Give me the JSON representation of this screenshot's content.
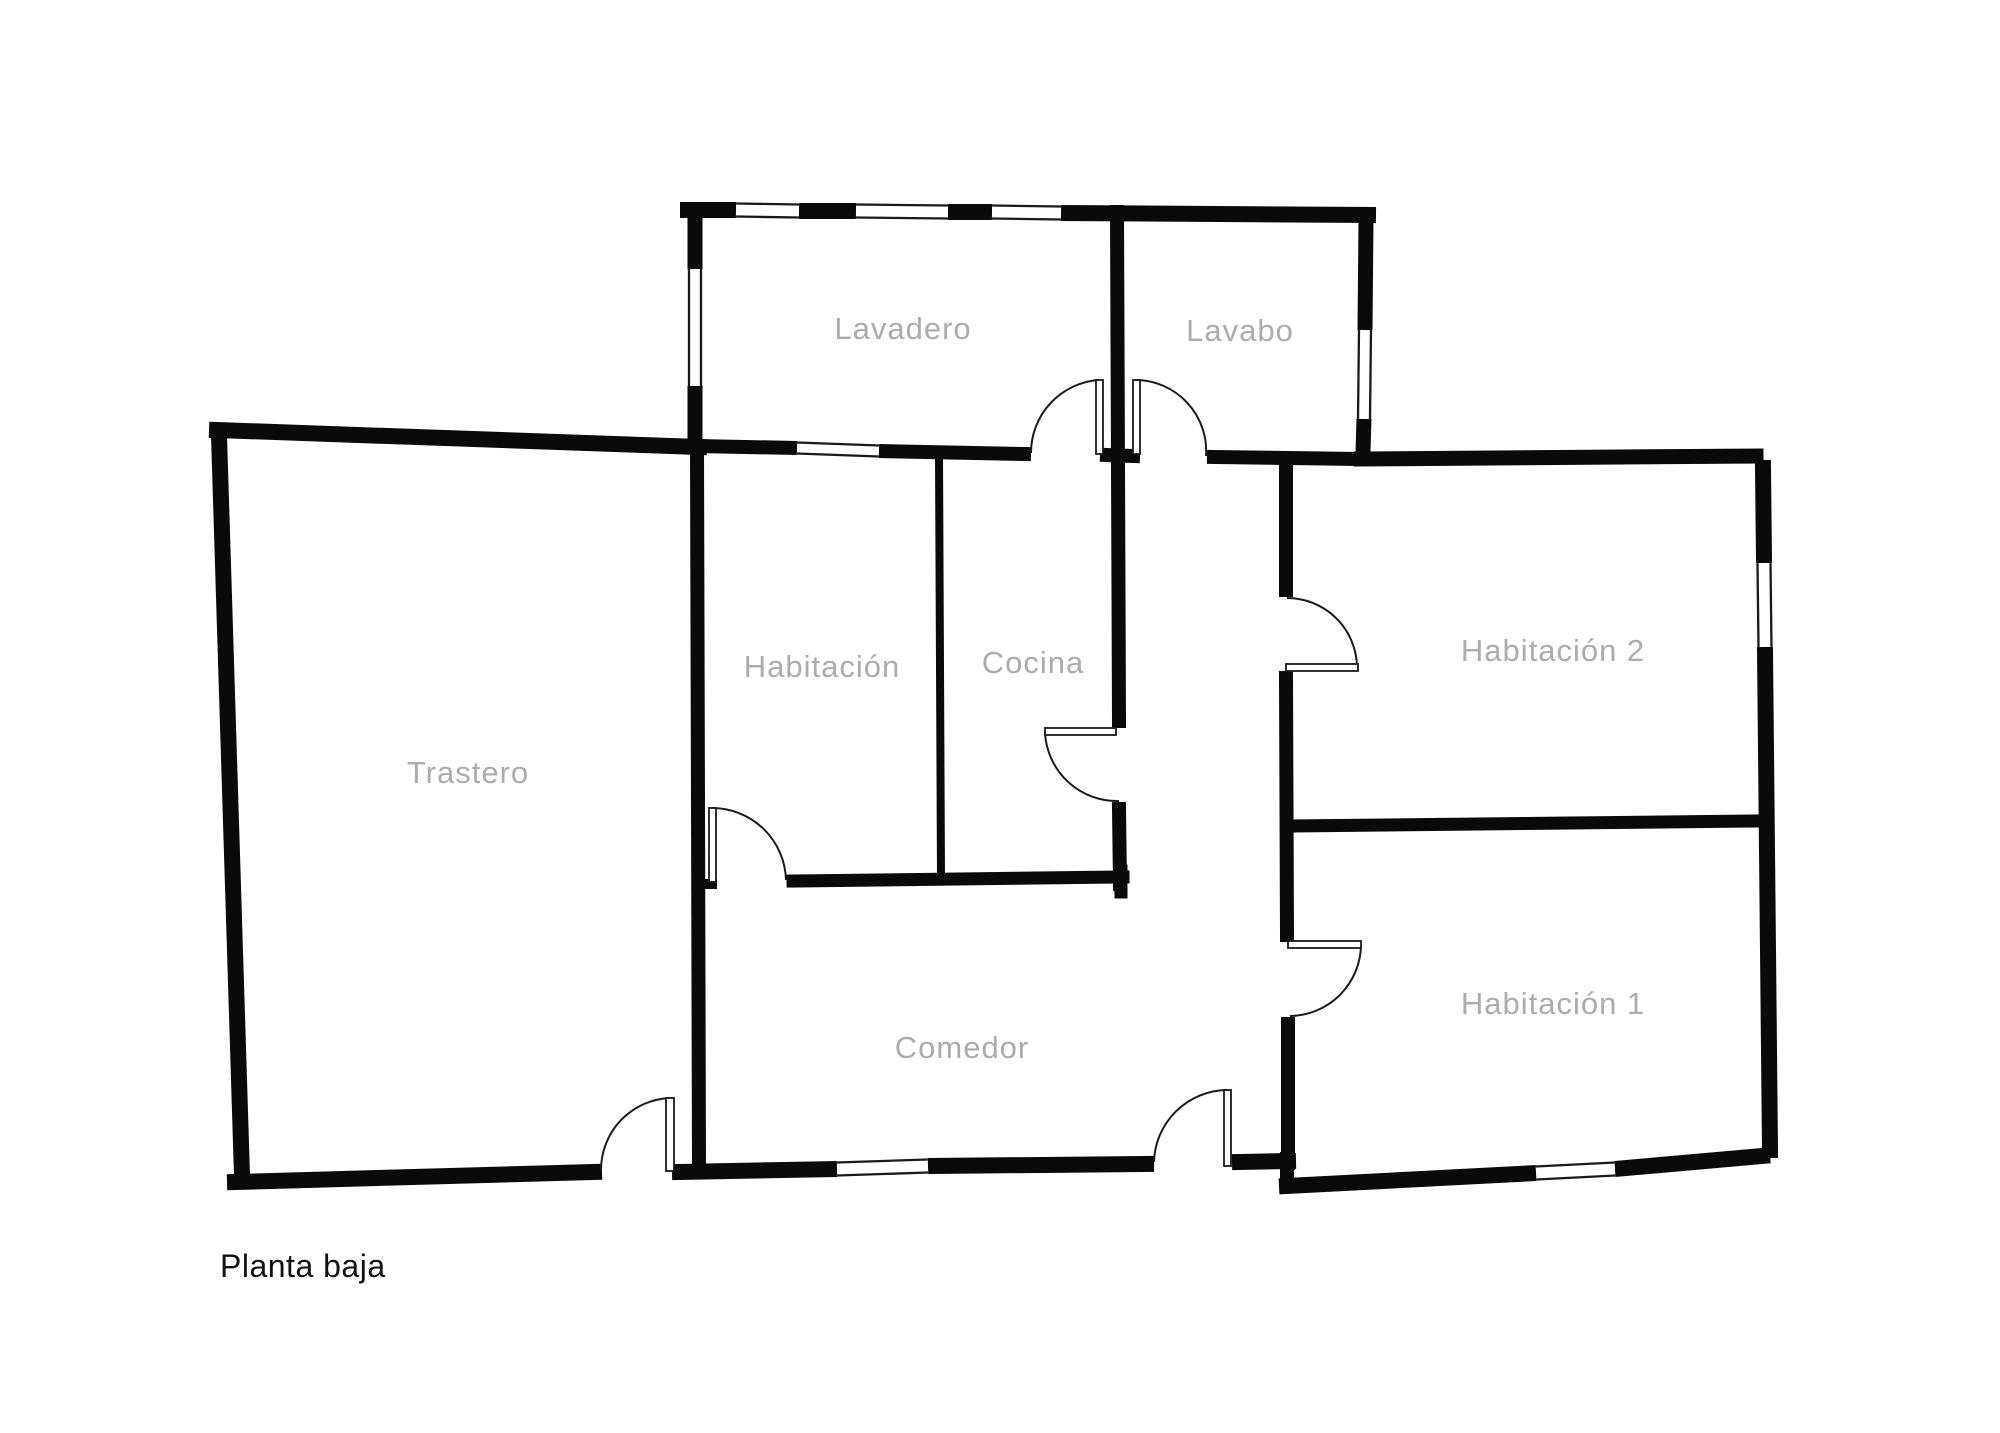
{
  "title": {
    "text": "Planta baja"
  },
  "colors": {
    "background": "#ffffff",
    "wall": "#0a0a0a",
    "door": "#1a1a1a",
    "room_label": "#acacac",
    "title_text": "#111111"
  },
  "floorplan": {
    "canvas": {
      "width": 2000,
      "height": 1433
    },
    "rooms": [
      {
        "id": "lavadero",
        "label": "Lavadero",
        "x": 903,
        "y": 328
      },
      {
        "id": "lavabo",
        "label": "Lavabo",
        "x": 1240,
        "y": 330
      },
      {
        "id": "habitacion",
        "label": "Habitación",
        "x": 822,
        "y": 666
      },
      {
        "id": "cocina",
        "label": "Cocina",
        "x": 1033,
        "y": 662
      },
      {
        "id": "trastero",
        "label": "Trastero",
        "x": 468,
        "y": 772
      },
      {
        "id": "habitacion-2",
        "label": "Habitación 2",
        "x": 1553,
        "y": 650
      },
      {
        "id": "habitacion-1",
        "label": "Habitación 1",
        "x": 1553,
        "y": 1003
      },
      {
        "id": "comedor",
        "label": "Comedor",
        "x": 962,
        "y": 1047
      }
    ],
    "walls": [
      {
        "x1": 688,
        "y1": 210,
        "x2": 736,
        "y2": 210,
        "w": 16
      },
      {
        "x1": 799,
        "y1": 211,
        "x2": 856,
        "y2": 211,
        "w": 16
      },
      {
        "x1": 948,
        "y1": 212,
        "x2": 992,
        "y2": 212,
        "w": 16
      },
      {
        "x1": 1061,
        "y1": 213,
        "x2": 1368,
        "y2": 215,
        "w": 16
      },
      {
        "x1": 695,
        "y1": 212,
        "x2": 695,
        "y2": 269,
        "w": 15
      },
      {
        "x1": 695,
        "y1": 390,
        "x2": 695,
        "y2": 442,
        "w": 15
      },
      {
        "x1": 1366,
        "y1": 219,
        "x2": 1365,
        "y2": 330,
        "w": 15
      },
      {
        "x1": 1364,
        "y1": 419,
        "x2": 1363,
        "y2": 452,
        "w": 15
      },
      {
        "x1": 217,
        "y1": 430,
        "x2": 699,
        "y2": 447,
        "w": 16
      },
      {
        "x1": 219,
        "y1": 436,
        "x2": 242,
        "y2": 1176,
        "w": 16
      },
      {
        "x1": 235,
        "y1": 1182,
        "x2": 594,
        "y2": 1172,
        "w": 16
      },
      {
        "x1": 680,
        "y1": 1172,
        "x2": 837,
        "y2": 1169,
        "w": 16
      },
      {
        "x1": 928,
        "y1": 1166,
        "x2": 1146,
        "y2": 1164,
        "w": 16
      },
      {
        "x1": 1240,
        "y1": 1162,
        "x2": 1288,
        "y2": 1161,
        "w": 16
      },
      {
        "x1": 1287,
        "y1": 1159,
        "x2": 1287,
        "y2": 1184,
        "w": 14
      },
      {
        "x1": 1287,
        "y1": 1186,
        "x2": 1536,
        "y2": 1173,
        "w": 16
      },
      {
        "x1": 1615,
        "y1": 1169,
        "x2": 1762,
        "y2": 1156,
        "w": 16
      },
      {
        "x1": 1763,
        "y1": 468,
        "x2": 1764,
        "y2": 560,
        "w": 16
      },
      {
        "x1": 1765,
        "y1": 651,
        "x2": 1770,
        "y2": 1150,
        "w": 16
      },
      {
        "x1": 697,
        "y1": 446,
        "x2": 797,
        "y2": 448,
        "w": 14
      },
      {
        "x1": 879,
        "y1": 451,
        "x2": 1024,
        "y2": 454,
        "w": 14
      },
      {
        "x1": 1107,
        "y1": 455,
        "x2": 1133,
        "y2": 456,
        "w": 14
      },
      {
        "x1": 1214,
        "y1": 457,
        "x2": 1361,
        "y2": 459,
        "w": 14
      },
      {
        "x1": 1361,
        "y1": 459,
        "x2": 1756,
        "y2": 456,
        "w": 15
      },
      {
        "x1": 1117,
        "y1": 212,
        "x2": 1119,
        "y2": 721,
        "w": 14
      },
      {
        "x1": 1119,
        "y1": 809,
        "x2": 1120,
        "y2": 884,
        "w": 14
      },
      {
        "x1": 697,
        "y1": 449,
        "x2": 699,
        "y2": 1166,
        "w": 14
      },
      {
        "x1": 939,
        "y1": 456,
        "x2": 941,
        "y2": 877,
        "w": 8
      },
      {
        "x1": 699,
        "y1": 884,
        "x2": 712,
        "y2": 884,
        "w": 10
      },
      {
        "x1": 793,
        "y1": 881,
        "x2": 1123,
        "y2": 877,
        "w": 13
      },
      {
        "x1": 1121,
        "y1": 871,
        "x2": 1121,
        "y2": 892,
        "w": 13
      },
      {
        "x1": 1286,
        "y1": 459,
        "x2": 1286,
        "y2": 590,
        "w": 14
      },
      {
        "x1": 1286,
        "y1": 678,
        "x2": 1287,
        "y2": 935,
        "w": 14
      },
      {
        "x1": 1288,
        "y1": 1024,
        "x2": 1288,
        "y2": 1163,
        "w": 14
      },
      {
        "x1": 1287,
        "y1": 826,
        "x2": 1758,
        "y2": 821,
        "w": 13
      }
    ],
    "windows": [
      {
        "x1": 736,
        "y1": 210,
        "x2": 799,
        "y2": 211,
        "w": 16
      },
      {
        "x1": 856,
        "y1": 211,
        "x2": 948,
        "y2": 212,
        "w": 16
      },
      {
        "x1": 992,
        "y1": 212,
        "x2": 1061,
        "y2": 213,
        "w": 16
      },
      {
        "x1": 695,
        "y1": 269,
        "x2": 695,
        "y2": 386,
        "w": 15
      },
      {
        "x1": 1365,
        "y1": 330,
        "x2": 1364,
        "y2": 419,
        "w": 15
      },
      {
        "x1": 1764,
        "y1": 563,
        "x2": 1765,
        "y2": 647,
        "w": 16
      },
      {
        "x1": 797,
        "y1": 448,
        "x2": 879,
        "y2": 451,
        "w": 14
      },
      {
        "x1": 837,
        "y1": 1169,
        "x2": 928,
        "y2": 1166,
        "w": 16
      },
      {
        "x1": 1536,
        "y1": 1173,
        "x2": 1615,
        "y2": 1169,
        "w": 16
      }
    ],
    "doors": [
      {
        "id": "lavadero-door",
        "leaf": {
          "x": 1096,
          "y": 380,
          "w": 7,
          "h": 74
        },
        "arc": "M 1099 380 A 73 73 0 0 0 1031 453"
      },
      {
        "id": "lavabo-door",
        "leaf": {
          "x": 1133,
          "y": 380,
          "w": 7,
          "h": 74
        },
        "arc": "M 1136 380 A 71 71 0 0 1 1206 456"
      },
      {
        "id": "cocina-door",
        "leaf": {
          "x": 1045,
          "y": 728,
          "w": 71,
          "h": 7
        },
        "arc": "M 1045 732 A 72 72 0 0 0 1119 801"
      },
      {
        "id": "habitacion2-door",
        "leaf": {
          "x": 1286,
          "y": 664,
          "w": 72,
          "h": 7
        },
        "arc": "M 1287 598 A 70 70 0 0 1 1357 667"
      },
      {
        "id": "habitacion1-door",
        "leaf": {
          "x": 1288,
          "y": 941,
          "w": 73,
          "h": 7
        },
        "arc": "M 1361 945 A 72 72 0 0 1 1290 1016"
      },
      {
        "id": "habitacion-door",
        "leaf": {
          "x": 709,
          "y": 808,
          "w": 7,
          "h": 74
        },
        "arc": "M 712 808 A 74 74 0 0 1 786 880"
      },
      {
        "id": "trastero-door",
        "leaf": {
          "x": 666,
          "y": 1098,
          "w": 8,
          "h": 73
        },
        "arc": "M 670 1098 A 72 72 0 0 0 601 1170"
      },
      {
        "id": "entrance-door",
        "leaf": {
          "x": 1224,
          "y": 1090,
          "w": 7,
          "h": 76
        },
        "arc": "M 1227 1090 A 74 74 0 0 0 1154 1162"
      }
    ]
  }
}
